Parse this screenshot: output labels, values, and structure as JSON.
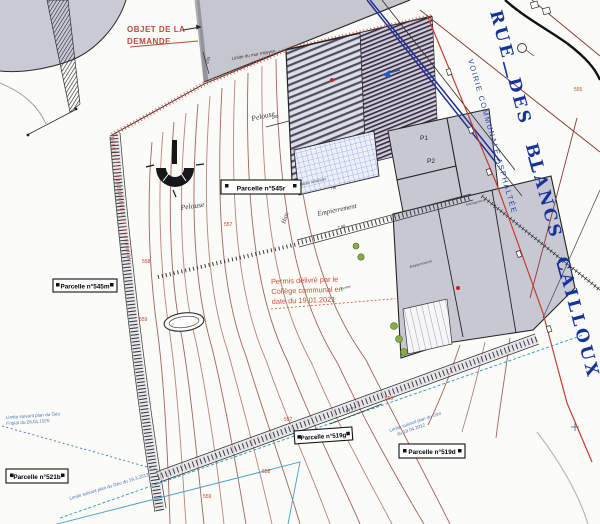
{
  "street": {
    "name": "RUE DES BLANCS CAILLOUX",
    "classification": "VOIRIE COMMUNALE ASPHALTÉE"
  },
  "request": {
    "title_line1": "OBJET DE LA",
    "title_line2": "DEMANDE"
  },
  "permit_stamp": {
    "line1": "Permis délivré par le",
    "line2": "Collège communal en",
    "line3": "date du 19.01.2021"
  },
  "parcels": [
    {
      "label": "Parcelle n°545r"
    },
    {
      "label": "Parcelle n°545m"
    },
    {
      "label": "Parcelle n°521b"
    },
    {
      "label": "Parcelle n°519g"
    },
    {
      "label": "Parcelle n°519d"
    }
  ],
  "surface_labels": {
    "pelouse_upper": "Pelouse",
    "pelouse_lower": "Pelouse",
    "empierrement_main": "Empierrement",
    "empierrement_small": "Empierrement",
    "haie": "Haie",
    "ferme": "Ferme",
    "dalles": "Dalles minérales",
    "amenagement": "Aménagement"
  },
  "building_marks": {
    "p1": "P1",
    "p2": "P2"
  },
  "contour_labels": [
    {
      "value": "555"
    },
    {
      "value": "557"
    },
    {
      "value": "558"
    },
    {
      "value": "559"
    },
    {
      "value": "557"
    },
    {
      "value": "556"
    },
    {
      "value": "558"
    },
    {
      "value": "559"
    }
  ],
  "dimensions": {
    "d233": "233",
    "d200": "200",
    "d700": "7.00",
    "d7m": "7m",
    "d4777": "47.77"
  },
  "boundary_notes": {
    "left_line1": "Limite suivant plan du Géo",
    "left_line2": "Fripiat du 26.01.1976",
    "bottom_diag": "Limite suivant plan du Géo du 19.3.2012",
    "mid_line1": "Limite suivant plan du Géo",
    "mid_line2": "du 19.04.2012",
    "top_wall": "Limite du mur mitoyen"
  },
  "colors": {
    "street_blue": "#16339c",
    "note_blue": "#4a72b8",
    "annotation_red": "#c3463c",
    "contour_maroon": "#9a544c",
    "building_grey": "#c8c8d3"
  }
}
